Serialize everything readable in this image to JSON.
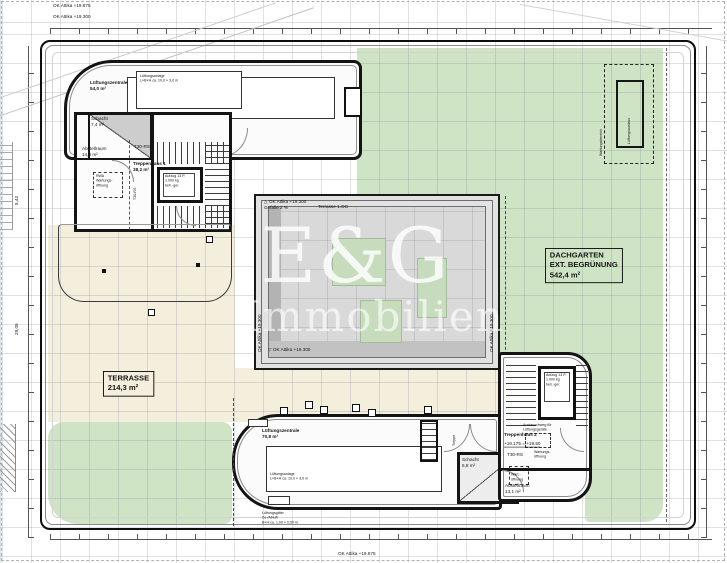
{
  "meta": {
    "drawing_type": "Dachaufsicht / roof floor plan",
    "colors": {
      "roof_green": "#cfe3c5",
      "terrace_beige": "#f4eedd",
      "wall_black": "#141414",
      "atrium_glass": "#d9d9d9",
      "watermark_white": "#ffffff"
    }
  },
  "watermark": {
    "brand": "E&G",
    "sub": "Immobilien"
  },
  "frame": {
    "level_a": "OK Attika +19.675",
    "level_b": "OK Attika +19.300",
    "level_bottom": "OK Attika +19.675",
    "dim_left_1": "5,42",
    "dim_left_2": "29,05"
  },
  "garden": {
    "title": "DACHGARTEN\nEXT. BEGRÜNUNG\n542,4 m²"
  },
  "terrace": {
    "title": "TERRASSE\n214,3 m²"
  },
  "north_wing": {
    "room": "Lüftungszentrale\n54,0 m²",
    "unit": "Lüftungsanlage\nL×B×H ca. 10,0 × 3,0 m"
  },
  "stair1": {
    "schacht": "Schacht\n7,4 m²",
    "abstell": "Abstellraum\n14,8 m²",
    "name": "Treppenhaus 1\n38,2 m²",
    "door": "T30-RS",
    "door_v": "T30-RS",
    "lift": "Aufzug 13 P.\n1.000 kg\nbeh.-ger.",
    "service": "RWA\nWartungs-\nöffnung"
  },
  "atrium": {
    "level": "△ OK Attika +19.300\nGefälle 2 %",
    "terr": "Terrasse 1.OG",
    "level_v_left": "OK Attika +19.300",
    "level_v_right": "OK Attika +19.300",
    "level_bottom": "▽ OK Attika +19.300"
  },
  "vent_ne": {
    "inner_v": "Lüftungsauslass",
    "outer_v": "Wartungsbereich"
  },
  "south_wing": {
    "room": "Lüftungszentrale\n70,8 m²",
    "unit": "Lüftungsanlage\nL×B×H ca. 10,0 × 3,0 m",
    "grille": "Lüftungsgitter\nZu-/Abluft\nB×H ca. 1,00 × 0,50 m",
    "schacht": "Schacht\n6,8 m²",
    "treppe_v": "Treppe"
  },
  "stair2": {
    "name": "Treppenhaus 2",
    "level": "+19.175 = +19.50",
    "door": "T30-RS",
    "abstell": "Abstellraum\n13,1 m²",
    "lift": "Aufzug 13 P.\n1.000 kg\nbeh.-ger.",
    "exchange": "Austauschweg für\nLüftungsgeräte",
    "service_a": "Wartungs-\nöffnung",
    "service_b": "RWA\nWart.-\nöffnung"
  }
}
